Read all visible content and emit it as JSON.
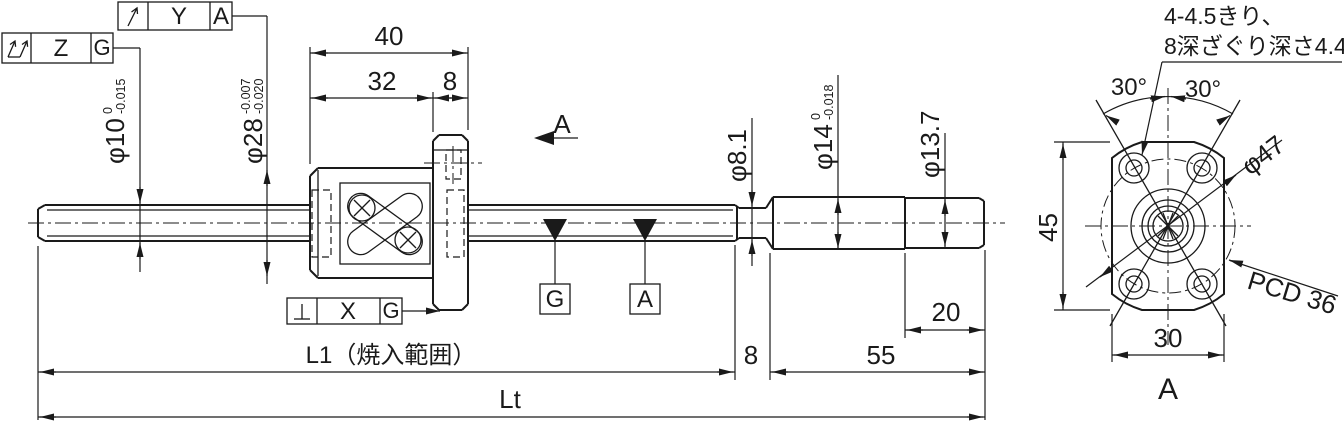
{
  "drawing": {
    "background": "#ffffff",
    "line_color": "#1a1a1a",
    "type": "ball-screw engineering drawing",
    "frames": {
      "circular_runout": {
        "symbol": "circular-runout-arrow",
        "tolerance": "Y",
        "datum": "A"
      },
      "total_runout": {
        "symbol": "total-runout-double-arrow",
        "tolerance": "Z",
        "datum": "G"
      },
      "perpendicularity": {
        "symbol": "perpendicularity",
        "tolerance": "X",
        "datum": "G"
      }
    },
    "datum_targets": {
      "g": "G",
      "a": "A"
    },
    "section_arrow_label": "A",
    "end_view_label": "A",
    "notes": {
      "line1": "4-4.5きり、",
      "line2": "8深ざぐり深さ4.4"
    },
    "dims": {
      "d40": "40",
      "d32": "32",
      "d8top": "8",
      "phi10": {
        "main": "φ10",
        "upper": "0",
        "lower": "-0.015"
      },
      "phi28": {
        "main": "φ28",
        "upper": "-0.007",
        "lower": "-0.020"
      },
      "phi81": "φ8.1",
      "phi14": {
        "main": "φ14",
        "upper": "0",
        "lower": "-0.018"
      },
      "phi137": "φ13.7",
      "phi47": "φ47",
      "pcd36": "PCD 36",
      "d45": "45",
      "d30": "30",
      "ang_left": "30°",
      "ang_right": "30°",
      "d8bottom": "8",
      "d55": "55",
      "d20": "20",
      "l1": "L1（焼入範囲）",
      "lt": "Lt"
    }
  }
}
